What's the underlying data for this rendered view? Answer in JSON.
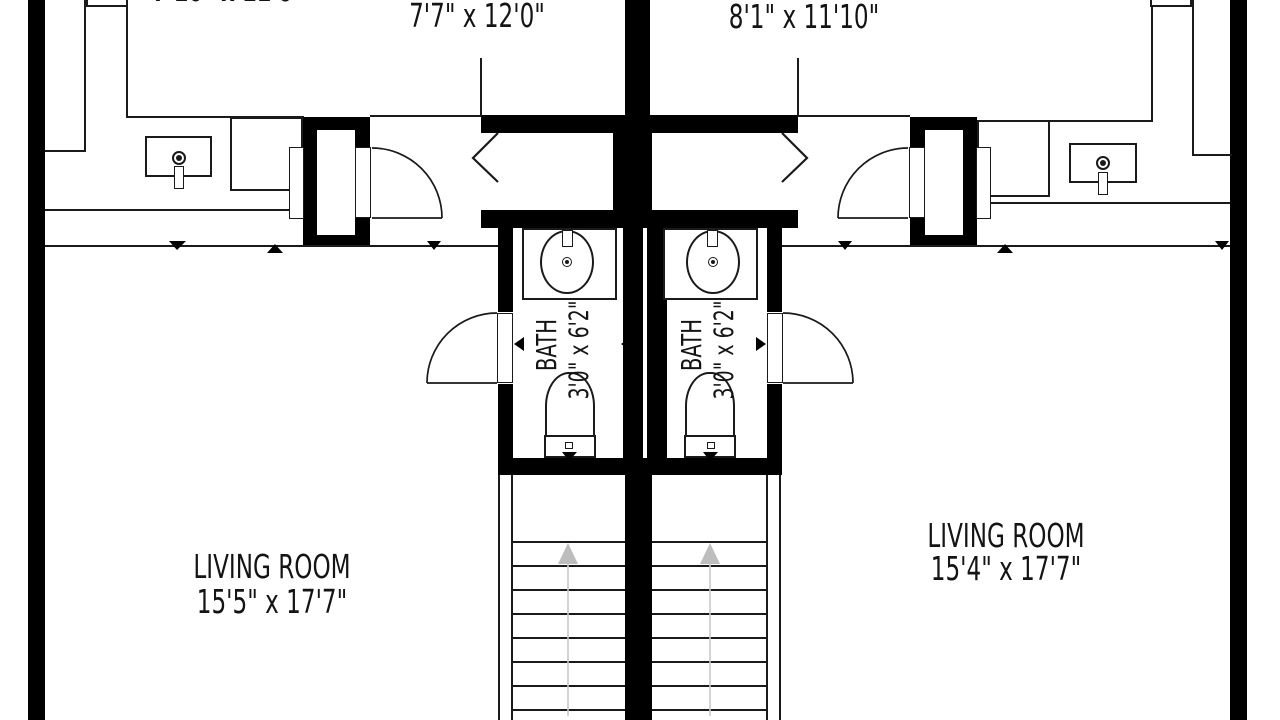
{
  "plan": {
    "title": "Duplex floor plan",
    "rooms": {
      "bedroom_left": {
        "dims": "7'10\" x 11'6\""
      },
      "bedroom_center": {
        "dims": "7'7\" x 12'0\""
      },
      "bedroom_right": {
        "dims": "8'1\" x 11'10\""
      },
      "bath_left": {
        "name": "BATH",
        "dims": "3'0\" x 6'2\""
      },
      "bath_right": {
        "name": "BATH",
        "dims": "3'0\" x 6'2\""
      },
      "living_left": {
        "name": "LIVING ROOM",
        "dims": "15'5\" x 17'7\""
      },
      "living_right": {
        "name": "LIVING ROOM",
        "dims": "15'4\" x 17'7\""
      }
    },
    "colors": {
      "wall": "#000000",
      "line": "#1a1a1a",
      "background": "#ffffff",
      "stair_arrow": "#c3c3c3"
    }
  }
}
